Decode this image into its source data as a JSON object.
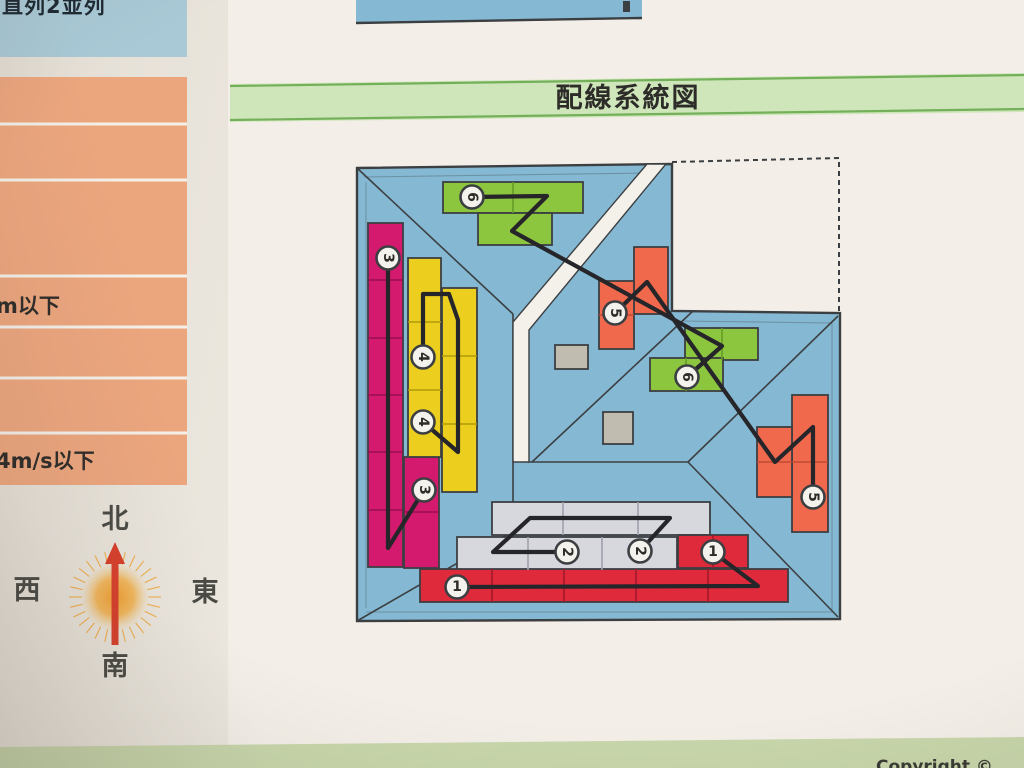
{
  "page": {
    "top_left_label": "直列2並列",
    "section_title": "配線系統図",
    "left_table": {
      "row_labels": [
        "m以下",
        "4m/s以下"
      ]
    },
    "compass": {
      "north": "北",
      "south": "南",
      "east": "東",
      "west": "西"
    },
    "footer_copyright": "Copyright ©"
  },
  "colors": {
    "paper_bright": "#f3efe8",
    "header_green_fill": "#cfe6bb",
    "header_green_line": "#74b05a",
    "footer_green": "#c8d6ab",
    "top_box_blue": "#a9c9d6",
    "table_salmon": "#eca67e",
    "table_line": "#f4f0e9",
    "roof_blue": "#85b9d3",
    "outline_dark": "#3c3f42",
    "white_band": "#f4f1ea",
    "wire": "#26262a",
    "marker_fill": "#f4f2ec",
    "panel_magenta": "#d31a6e",
    "panel_magenta_line": "#970f4e",
    "panel_yellow": "#eccf1e",
    "panel_yellow_line": "#b09a08",
    "panel_green": "#8cc63f",
    "panel_green_line": "#649b27",
    "panel_orange": "#f0694d",
    "panel_orange_line": "#bf4a33",
    "panel_red": "#df2a3c",
    "panel_red_line": "#a3182a",
    "panel_gray": "#d7d7de",
    "panel_gray_line": "#9fa0ab",
    "vent_gray": "#c1bcb0",
    "compass_sun": "#f0a12b",
    "compass_arrow": "#d6402c",
    "text_dark": "#2e2c29",
    "compass_text": "#4a4a45"
  },
  "diagram": {
    "panels": [
      {
        "name": "panel-green-north-a",
        "x": 443,
        "y": 182,
        "w": 140,
        "h": 31,
        "fill": "panel_green"
      },
      {
        "name": "panel-green-north-b",
        "x": 478,
        "y": 213,
        "w": 74,
        "h": 32,
        "fill": "panel_green"
      },
      {
        "name": "panel-magenta-west-a",
        "x": 368,
        "y": 223,
        "w": 35,
        "h": 344,
        "fill": "panel_magenta"
      },
      {
        "name": "panel-magenta-west-b",
        "x": 404,
        "y": 457,
        "w": 35,
        "h": 111,
        "fill": "panel_magenta"
      },
      {
        "name": "panel-yellow-west-a",
        "x": 408,
        "y": 258,
        "w": 33,
        "h": 199,
        "fill": "panel_yellow"
      },
      {
        "name": "panel-yellow-west-b",
        "x": 442,
        "y": 288,
        "w": 35,
        "h": 204,
        "fill": "panel_yellow"
      },
      {
        "name": "panel-orange-center-a",
        "x": 634,
        "y": 247,
        "w": 34,
        "h": 67,
        "fill": "panel_orange"
      },
      {
        "name": "panel-orange-center-b",
        "x": 599,
        "y": 281,
        "w": 35,
        "h": 68,
        "fill": "panel_orange"
      },
      {
        "name": "panel-green-east-a",
        "x": 685,
        "y": 328,
        "w": 73,
        "h": 32,
        "fill": "panel_green"
      },
      {
        "name": "panel-green-east-b",
        "x": 650,
        "y": 358,
        "w": 73,
        "h": 33,
        "fill": "panel_green"
      },
      {
        "name": "panel-orange-east-a",
        "x": 792,
        "y": 395,
        "w": 36,
        "h": 137,
        "fill": "panel_orange"
      },
      {
        "name": "panel-orange-east-b",
        "x": 757,
        "y": 427,
        "w": 35,
        "h": 70,
        "fill": "panel_orange"
      },
      {
        "name": "panel-gray-south-a",
        "x": 492,
        "y": 502,
        "w": 218,
        "h": 33,
        "fill": "panel_gray"
      },
      {
        "name": "panel-gray-south-b",
        "x": 457,
        "y": 537,
        "w": 220,
        "h": 33,
        "fill": "panel_gray"
      },
      {
        "name": "panel-red-south-row",
        "x": 420,
        "y": 569,
        "w": 368,
        "h": 33,
        "fill": "panel_red"
      },
      {
        "name": "panel-red-south-block",
        "x": 678,
        "y": 535,
        "w": 70,
        "h": 33,
        "fill": "panel_red"
      },
      {
        "name": "roof-vent-a",
        "x": 555,
        "y": 345,
        "w": 33,
        "h": 24,
        "fill": "vent_gray"
      },
      {
        "name": "roof-vent-b",
        "x": 603,
        "y": 412,
        "w": 30,
        "h": 32,
        "fill": "vent_gray"
      }
    ],
    "grid_lines": [
      {
        "x1": 368,
        "y1": 280,
        "x2": 403,
        "y2": 280,
        "c": "panel_magenta_line"
      },
      {
        "x1": 368,
        "y1": 338,
        "x2": 403,
        "y2": 338,
        "c": "panel_magenta_line"
      },
      {
        "x1": 368,
        "y1": 395,
        "x2": 403,
        "y2": 395,
        "c": "panel_magenta_line"
      },
      {
        "x1": 368,
        "y1": 452,
        "x2": 403,
        "y2": 452,
        "c": "panel_magenta_line"
      },
      {
        "x1": 368,
        "y1": 510,
        "x2": 403,
        "y2": 510,
        "c": "panel_magenta_line"
      },
      {
        "x1": 404,
        "y1": 512,
        "x2": 439,
        "y2": 512,
        "c": "panel_magenta_line"
      },
      {
        "x1": 408,
        "y1": 322,
        "x2": 441,
        "y2": 322,
        "c": "panel_yellow_line"
      },
      {
        "x1": 408,
        "y1": 390,
        "x2": 441,
        "y2": 390,
        "c": "panel_yellow_line"
      },
      {
        "x1": 442,
        "y1": 356,
        "x2": 477,
        "y2": 356,
        "c": "panel_yellow_line"
      },
      {
        "x1": 442,
        "y1": 424,
        "x2": 477,
        "y2": 424,
        "c": "panel_yellow_line"
      },
      {
        "x1": 513,
        "y1": 182,
        "x2": 513,
        "y2": 213,
        "c": "panel_green_line"
      },
      {
        "x1": 722,
        "y1": 328,
        "x2": 722,
        "y2": 360,
        "c": "panel_green_line"
      },
      {
        "x1": 686,
        "y1": 358,
        "x2": 686,
        "y2": 391,
        "c": "panel_green_line"
      },
      {
        "x1": 599,
        "y1": 315,
        "x2": 634,
        "y2": 315,
        "c": "panel_orange_line"
      },
      {
        "x1": 757,
        "y1": 462,
        "x2": 828,
        "y2": 462,
        "c": "panel_orange_line"
      },
      {
        "x1": 563,
        "y1": 502,
        "x2": 563,
        "y2": 535,
        "c": "panel_gray_line"
      },
      {
        "x1": 638,
        "y1": 502,
        "x2": 638,
        "y2": 535,
        "c": "panel_gray_line"
      },
      {
        "x1": 528,
        "y1": 537,
        "x2": 528,
        "y2": 570,
        "c": "panel_gray_line"
      },
      {
        "x1": 602,
        "y1": 537,
        "x2": 602,
        "y2": 570,
        "c": "panel_gray_line"
      },
      {
        "x1": 492,
        "y1": 569,
        "x2": 492,
        "y2": 602,
        "c": "panel_red_line"
      },
      {
        "x1": 564,
        "y1": 569,
        "x2": 564,
        "y2": 602,
        "c": "panel_red_line"
      },
      {
        "x1": 636,
        "y1": 569,
        "x2": 636,
        "y2": 602,
        "c": "panel_red_line"
      },
      {
        "x1": 708,
        "y1": 569,
        "x2": 708,
        "y2": 602,
        "c": "panel_red_line"
      },
      {
        "x1": 713,
        "y1": 535,
        "x2": 713,
        "y2": 568,
        "c": "panel_red_line"
      }
    ],
    "wires": [
      "M457,587 L758,586 L713,552",
      "M567,552 L493,552 L530,518 L670,518 L640,551",
      "M388,258 L388,548 L424,490",
      "M423,357 L423,294 L449,294 L458,320 L458,452 L423,422",
      "M615,313 L647,282 L775,462 L813,427 L813,497",
      "M472,197 L547,196 L512,231 L722,346 L687,377"
    ],
    "markers": [
      {
        "x": 457,
        "y": 587,
        "label": "1",
        "rot": 0
      },
      {
        "x": 713,
        "y": 552,
        "label": "1",
        "rot": 0
      },
      {
        "x": 567,
        "y": 552,
        "label": "2",
        "rot": 90
      },
      {
        "x": 640,
        "y": 551,
        "label": "2",
        "rot": 90
      },
      {
        "x": 388,
        "y": 258,
        "label": "3",
        "rot": 90
      },
      {
        "x": 424,
        "y": 490,
        "label": "3",
        "rot": 90
      },
      {
        "x": 423,
        "y": 357,
        "label": "4",
        "rot": 90
      },
      {
        "x": 423,
        "y": 422,
        "label": "4",
        "rot": 90
      },
      {
        "x": 615,
        "y": 313,
        "label": "5",
        "rot": 90
      },
      {
        "x": 813,
        "y": 497,
        "label": "5",
        "rot": 90
      },
      {
        "x": 472,
        "y": 197,
        "label": "6",
        "rot": 90
      },
      {
        "x": 687,
        "y": 377,
        "label": "6",
        "rot": 90
      }
    ]
  }
}
